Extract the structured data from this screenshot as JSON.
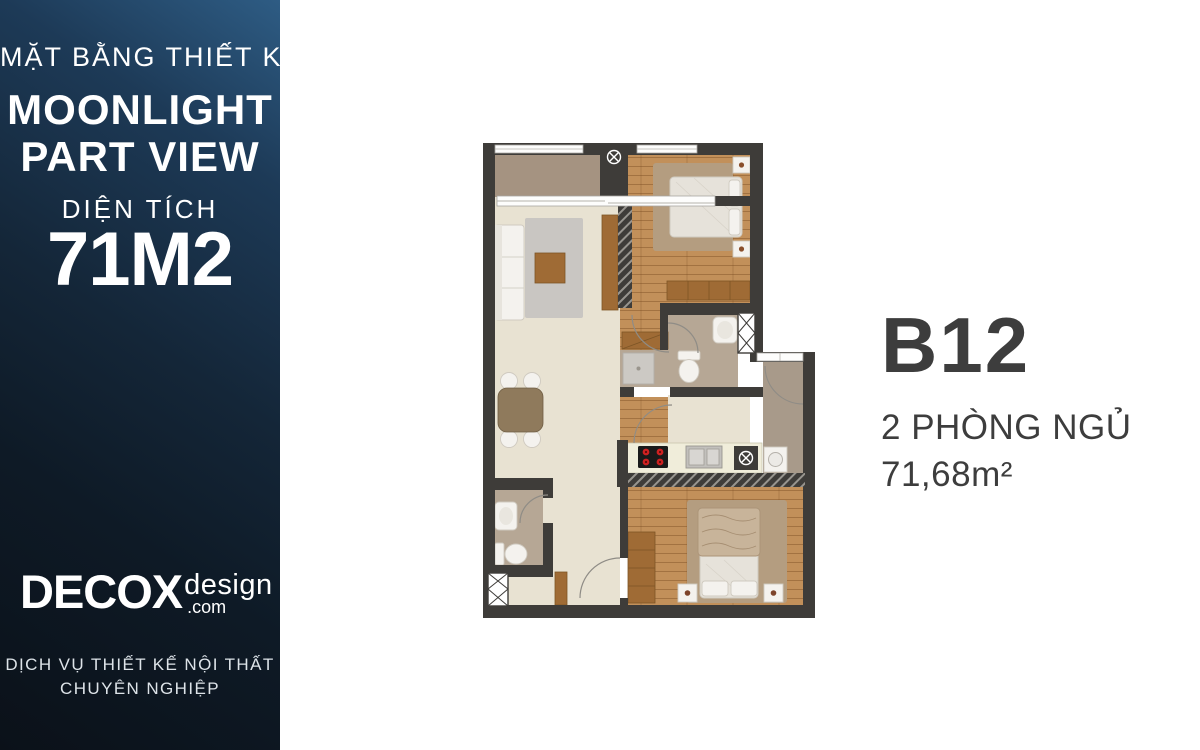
{
  "sidebar": {
    "subtitle": "MẶT BẰNG THIẾT KẾ",
    "project_line1": "MOONLIGHT",
    "project_line2": "PART VIEW",
    "area_label": "DIỆN TÍCH",
    "area_value": "71M2",
    "logo": {
      "brand": "DECOX",
      "suffix": "design",
      "domain": ".com"
    },
    "slogan_line1": "DỊCH VỤ THIẾT KẾ NỘI THẤT",
    "slogan_line2": "CHUYÊN NGHIỆP"
  },
  "unit_info": {
    "code": "B12",
    "bedrooms": "2 PHÒNG NGỦ",
    "area": "71,68m²"
  },
  "colors": {
    "sidebar_top": "#2e5c84",
    "sidebar_upper": "#1d3a57",
    "sidebar_mid": "#142638",
    "sidebar_low": "#0e1a26",
    "sidebar_bottom": "#0b1119",
    "sidebar_text": "#ffffff",
    "slogan_text": "#dde3e8",
    "unit_text": "#3d3d3d",
    "wall": "#3e3c39",
    "floor_wood": "#c2905a",
    "floor_living": "#e8e2d2",
    "floor_balcony": "#a59381",
    "floor_bath": "#b6a795",
    "floor_entry": "#a89a8a",
    "counter": "#f0edda",
    "cabinet_wood": "#9f6b35",
    "rug_gray": "#c9c6c2",
    "rug_tan": "#b49d80",
    "furniture_white": "#f4f2ee",
    "stove_black": "#1a1a1a",
    "burner_red": "#ce2121",
    "mattress": "#e6e2da"
  }
}
